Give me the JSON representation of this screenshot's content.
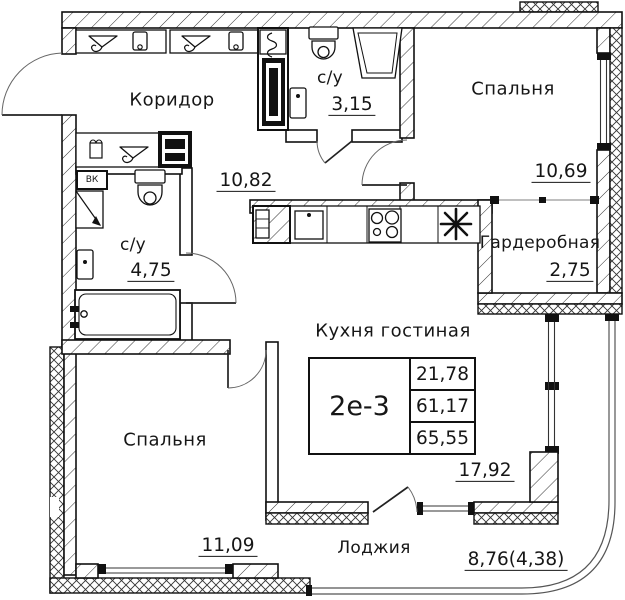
{
  "meta": {
    "background": "#ffffff",
    "line_color": "#111111"
  },
  "rooms": {
    "corridor": {
      "name": "Коридор",
      "area": "10,82"
    },
    "bath_top": {
      "name": "с/у",
      "area": "3,15"
    },
    "bedroom_top": {
      "name": "Спальня",
      "area": "10,69"
    },
    "wardrobe": {
      "name": "Гардеробная",
      "area": "2,75"
    },
    "bath_left": {
      "name": "с/у",
      "area": "4,75"
    },
    "kitchen_living": {
      "name": "Кухня гостиная",
      "area": "17,92"
    },
    "bedroom_bottom": {
      "name": "Спальня",
      "area": "11,09"
    },
    "loggia": {
      "name": "Лоджия",
      "area": "8,76(4,38)"
    }
  },
  "unit_card": {
    "type": "2е-3",
    "living_area": "21,78",
    "apartment_area": "61,17",
    "total_area": "65,55"
  },
  "annotations": {
    "utility_box": "ВК"
  }
}
